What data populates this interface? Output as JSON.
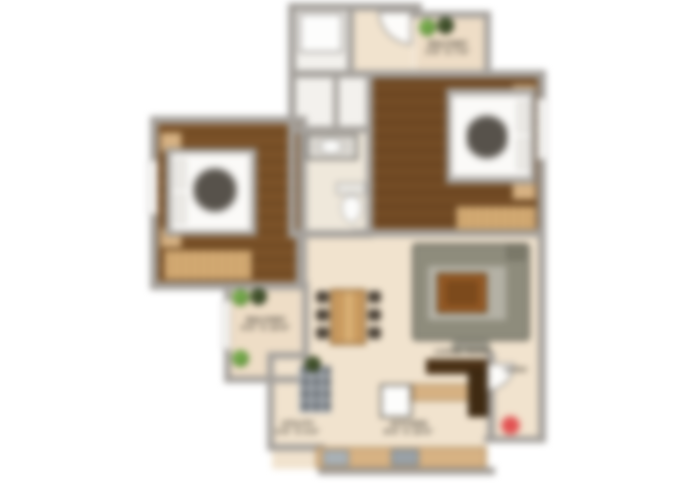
{
  "image": {
    "type": "residential-apartment-floor-plan",
    "rendering": "colored 2D plan, heavily blurred / low-resolution"
  },
  "palette": {
    "background": "#ffffff",
    "wall_gray": "#a5a19c",
    "bedroom_wood_left": "#7b5229",
    "bedroom_wood_right": "#744c26",
    "floor_beige": "#f1e3ce",
    "balcony_beige": "#eeddc6",
    "bath_floor": "#f3f1ed",
    "counter_tan": "#d7b283",
    "wardrobe_tan": "#c59a5f",
    "sofa_gray": "#8e8c7c",
    "rug_gray": "#b4b1a5",
    "coffee_table_brown": "#9a5c26",
    "tv_unit_brown": "#4a3015",
    "plant_green": "#5f9a3c",
    "plant_dark": "#33421f",
    "entry_marker_red": "#e25252",
    "label_text": "#3e3930"
  },
  "labels": {
    "balcony_top": {
      "line1": "BALCONY",
      "line2": "3'6\" X 7'0\""
    },
    "balcony_left": {
      "line1": "BALCONY",
      "line2": "4'0\" X 10'0\""
    },
    "living": {
      "line1": "LIVING ROOM"
    },
    "kitchen": {
      "line1": "KITCHEN",
      "line2": "8'0\" X 10'0\""
    },
    "utility": {
      "line1": "UTILITY",
      "line2": "3'0\" X 4'0\""
    },
    "entry": {
      "line1": "ENTRY"
    }
  },
  "icons": {
    "plants": "potted-plant-icon",
    "entry_marker": "red-entry-dot-icon",
    "door_swings": "quarter-circle-door-arc"
  }
}
